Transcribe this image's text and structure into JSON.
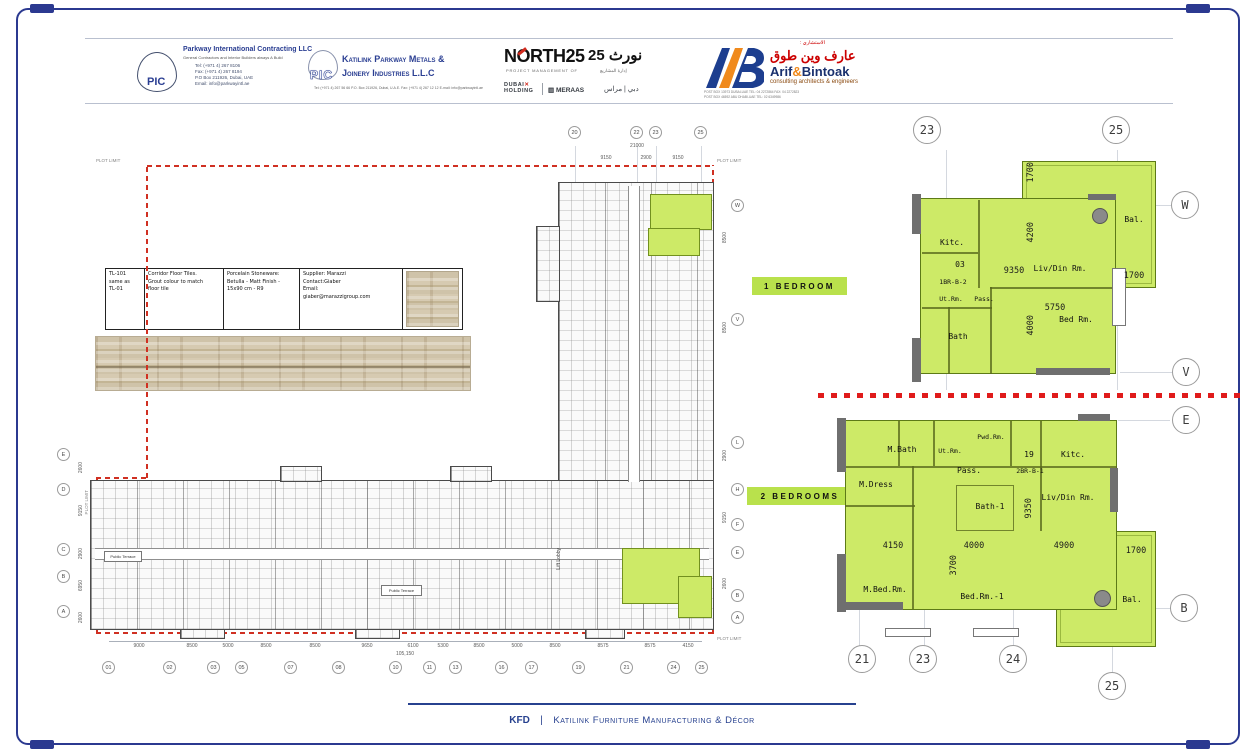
{
  "colors": {
    "accent_blue": "#2b3990",
    "highlight_green": "#cdea67",
    "chip_green": "#b9e14c",
    "plot_red": "#d03022",
    "ab_orange": "#f08a1d"
  },
  "header": {
    "pic": {
      "abbr": "PIC",
      "title": "Parkway International Contracting LLC",
      "subtitle": "General Contractors and Interior Builders always A Build",
      "lines": [
        "Tel: (+971 4) 267 8106",
        "Fax: (+971 4) 267 8194",
        "P.O Box 211926, Dubai, UAE",
        "Email: info@parkwayintl.ae"
      ]
    },
    "katilink": {
      "abbr": "PIC",
      "line1": "Katilink Parkway Metals &",
      "line2": "Joinery Industries L.L.C",
      "contact": "Tel: (+971 4) 267 56 66  P.O. Box 211926, Dubai, U.A.E.  Fax: (+971 4) 267 12 12  E-mail: info@parkwayintl.ae"
    },
    "north25": {
      "logo": "NORTH25",
      "logo_ar": "نورث 25",
      "tagline": "PROJECT MANAGEMENT OF",
      "tagline_ar": "إدارة المشاريع",
      "dubai": "DUBAI",
      "holding": "HOLDING",
      "meraas": "MERAAS",
      "brands_ar": "دبي | مراس"
    },
    "arif": {
      "consultant_ar": "الاستشاري :",
      "name_ar": "عارف وين طوق",
      "name_left": "Arif",
      "amp": "&",
      "name_right": "Bintoak",
      "tagline": "consulting  architects &  engineers",
      "addr1": "POST BOX 13973 DUBAI-UAE  TEL: 04 2272864  FAX: 04 2272823",
      "addr2": "POST BOX 46592 ABU DHABI-UAE  TEL: 02 6349986"
    }
  },
  "spec_table": {
    "code": "TL-101\nsame as\nTL-01",
    "desc": "Corridor Floor Tiles.\nGrout colour to match\nfloor tile",
    "material": "Porcelain Stoneware:\nBetulla - Matt Finish -\n15x90 cm  - R9",
    "supplier": "Supplier: Marazzi\nContact:Giaber\nEmail:\ngiaber@marazzigroup.com"
  },
  "chips": {
    "one_bedroom": "1 BEDROOM",
    "two_bedrooms": "2 BEDROOMS"
  },
  "main_plan": {
    "plot_limit": "PLOT LIMIT",
    "top_bubbles": [
      "20",
      "22",
      "23",
      "25"
    ],
    "top_dims": [
      "9150",
      "2900",
      "9150"
    ],
    "top_total": "21000",
    "bottom_bubbles": [
      "01",
      "02",
      "03",
      "05",
      "07",
      "08",
      "10",
      "11",
      "13",
      "16",
      "17",
      "19",
      "21",
      "24",
      "25"
    ],
    "bottom_dims": [
      "9000",
      "8500",
      "5000",
      "8500",
      "8500",
      "9650",
      "6100",
      "5300",
      "8500",
      "5000",
      "8500",
      "8575",
      "8575",
      "4150"
    ],
    "bottom_total": "105,150",
    "left_bubbles": [
      "E",
      "D",
      "C",
      "B",
      "A"
    ],
    "left_dims": [
      "2600",
      "9150",
      "2900",
      "6950",
      "2600"
    ],
    "right_bubbles": [
      "W",
      "V",
      "L",
      "H",
      "F",
      "E",
      "B",
      "A"
    ],
    "right_dims": [
      "8500",
      "8500",
      "2900",
      "9150",
      "2600"
    ],
    "public_terrace": "Public Terrace",
    "lift_lobby": "Lift Lobby"
  },
  "unit1": {
    "bubbles": {
      "b23": "23",
      "b25": "25",
      "w": "W",
      "v": "V"
    },
    "rooms": {
      "kitc": "Kitc.",
      "num": "03",
      "code": "1BR-B-2",
      "ut": "Ut.Rm.",
      "pass": "Pass.",
      "bath": "Bath",
      "liv": "Liv/Din Rm.",
      "bed": "Bed Rm.",
      "bal": "Bal."
    },
    "dims": {
      "d9350": "9350",
      "d5750": "5750",
      "d4200": "4200",
      "d4000": "4000",
      "d1700v": "1700",
      "d1700h": "1700"
    }
  },
  "unit2": {
    "bubbles": {
      "b21": "21",
      "b23": "23",
      "b24": "24",
      "b25": "25",
      "e": "E",
      "b": "B"
    },
    "rooms": {
      "mbath": "M.Bath",
      "ut": "Ut.Rm.",
      "pwd": "Pwd.Rm.",
      "pass": "Pass.",
      "num": "19",
      "code": "2BR-B-1",
      "kitc": "Kitc.",
      "mdress": "M.Dress",
      "bath1": "Bath-1",
      "liv": "Liv/Din Rm.",
      "mbed": "M.Bed.Rm.",
      "bed1": "Bed.Rm.-1",
      "bal": "Bal."
    },
    "dims": {
      "d4150": "4150",
      "d4000": "4000",
      "d3700": "3700",
      "d9350": "9350",
      "d4900": "4900",
      "d1700": "1700"
    }
  },
  "footer": {
    "kfd": "KFD",
    "sep": "|",
    "label": "Katilink Furniture Manufacturing & Décor"
  }
}
